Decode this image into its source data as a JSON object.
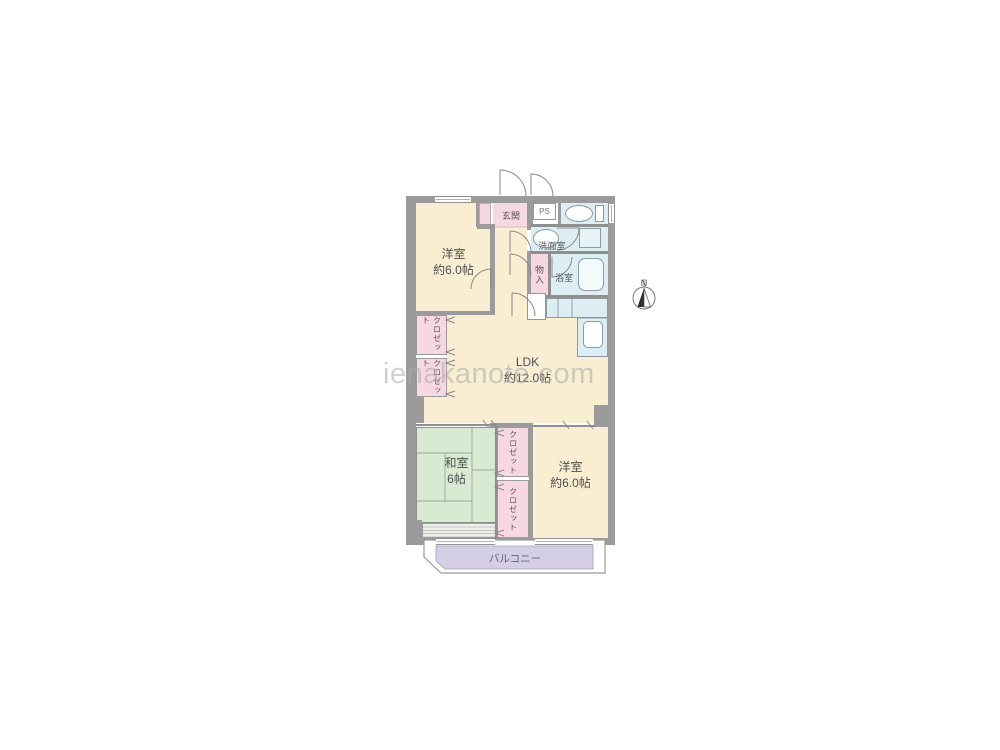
{
  "watermark": "ienakanote.com",
  "compass": {
    "north_label": "N"
  },
  "rooms": {
    "bedroom_nw": {
      "name": "洋室",
      "size": "約6.0帖"
    },
    "ldk": {
      "name": "LDK",
      "size": "約12.0帖"
    },
    "japanese_room": {
      "name": "和室",
      "size": "6帖"
    },
    "bedroom_se": {
      "name": "洋室",
      "size": "約6.0帖"
    },
    "entrance": {
      "name": "玄関"
    },
    "pipe_space": {
      "name": "PS"
    },
    "washroom": {
      "name": "洗面室"
    },
    "bathroom": {
      "name": "浴室"
    },
    "storage": {
      "name": "物入"
    },
    "closet": {
      "name": "クロゼット"
    },
    "balcony": {
      "name": "バルコニー"
    }
  },
  "colors": {
    "wall": "#9b9b9b",
    "western_room": "#f9eed2",
    "tatami": "#d9ead2",
    "closet": "#f8d8e0",
    "wet_area": "#dceef3",
    "balcony": "#d5cfe6",
    "watermark_gray": "#cccccc"
  }
}
